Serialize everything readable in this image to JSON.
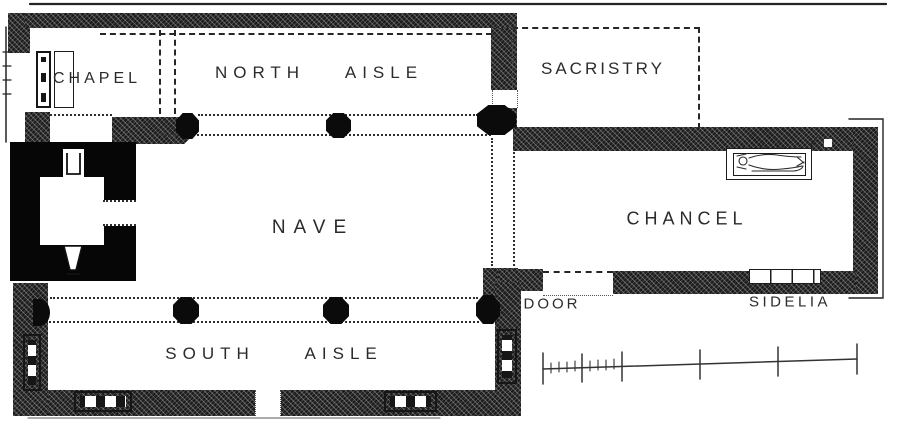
{
  "labels": {
    "chapel": "CHAPEL",
    "north_aisle": "NORTH AISLE",
    "sacristry": "SACRISTRY",
    "nave": "NAVE",
    "chancel": "CHANCEL",
    "south_aisle": "SOUTH AISLE",
    "door": "DOOR",
    "sedilia": "SIDELIA"
  },
  "features": [
    "west-tower-solid-walls",
    "octagonal-arcade-piers",
    "tomb-with-effigy",
    "sedilia-recess",
    "mullioned-windows",
    "unlabelled-scale-bar",
    "dashed-sacristry-outline"
  ],
  "colors": {
    "background": "#ffffff",
    "ink": "#2b2b2b",
    "wall_hatched": "#1b1b1b",
    "wall_solid": "#060606"
  }
}
